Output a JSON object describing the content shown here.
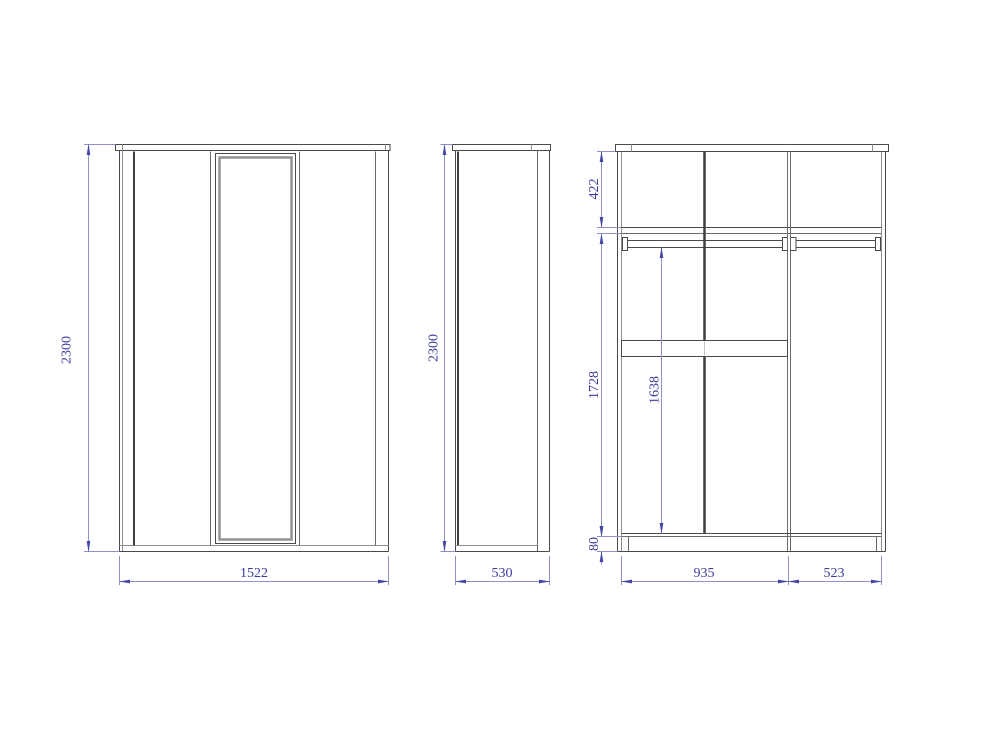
{
  "drawing_type": "wardrobe-three-view-dimension-drawing",
  "views": {
    "front": {
      "height": "2300",
      "width": "1522"
    },
    "side": {
      "height": "2300",
      "depth": "530"
    },
    "interior": {
      "top_section_height": "422",
      "lower_section_height": "1728",
      "rail_clearance": "1638",
      "plinth_height": "80",
      "left_section_width": "935",
      "right_section_width": "523"
    }
  },
  "colors": {
    "background": "#ffffff",
    "outline": "#4a4a4a",
    "outline_dark": "#3f3f3f",
    "outline_light": "#8f8f8f",
    "dimension_line": "#8f8fcc",
    "dimension_arrow": "#4545a8",
    "dimension_text": "#3b3b9e"
  }
}
